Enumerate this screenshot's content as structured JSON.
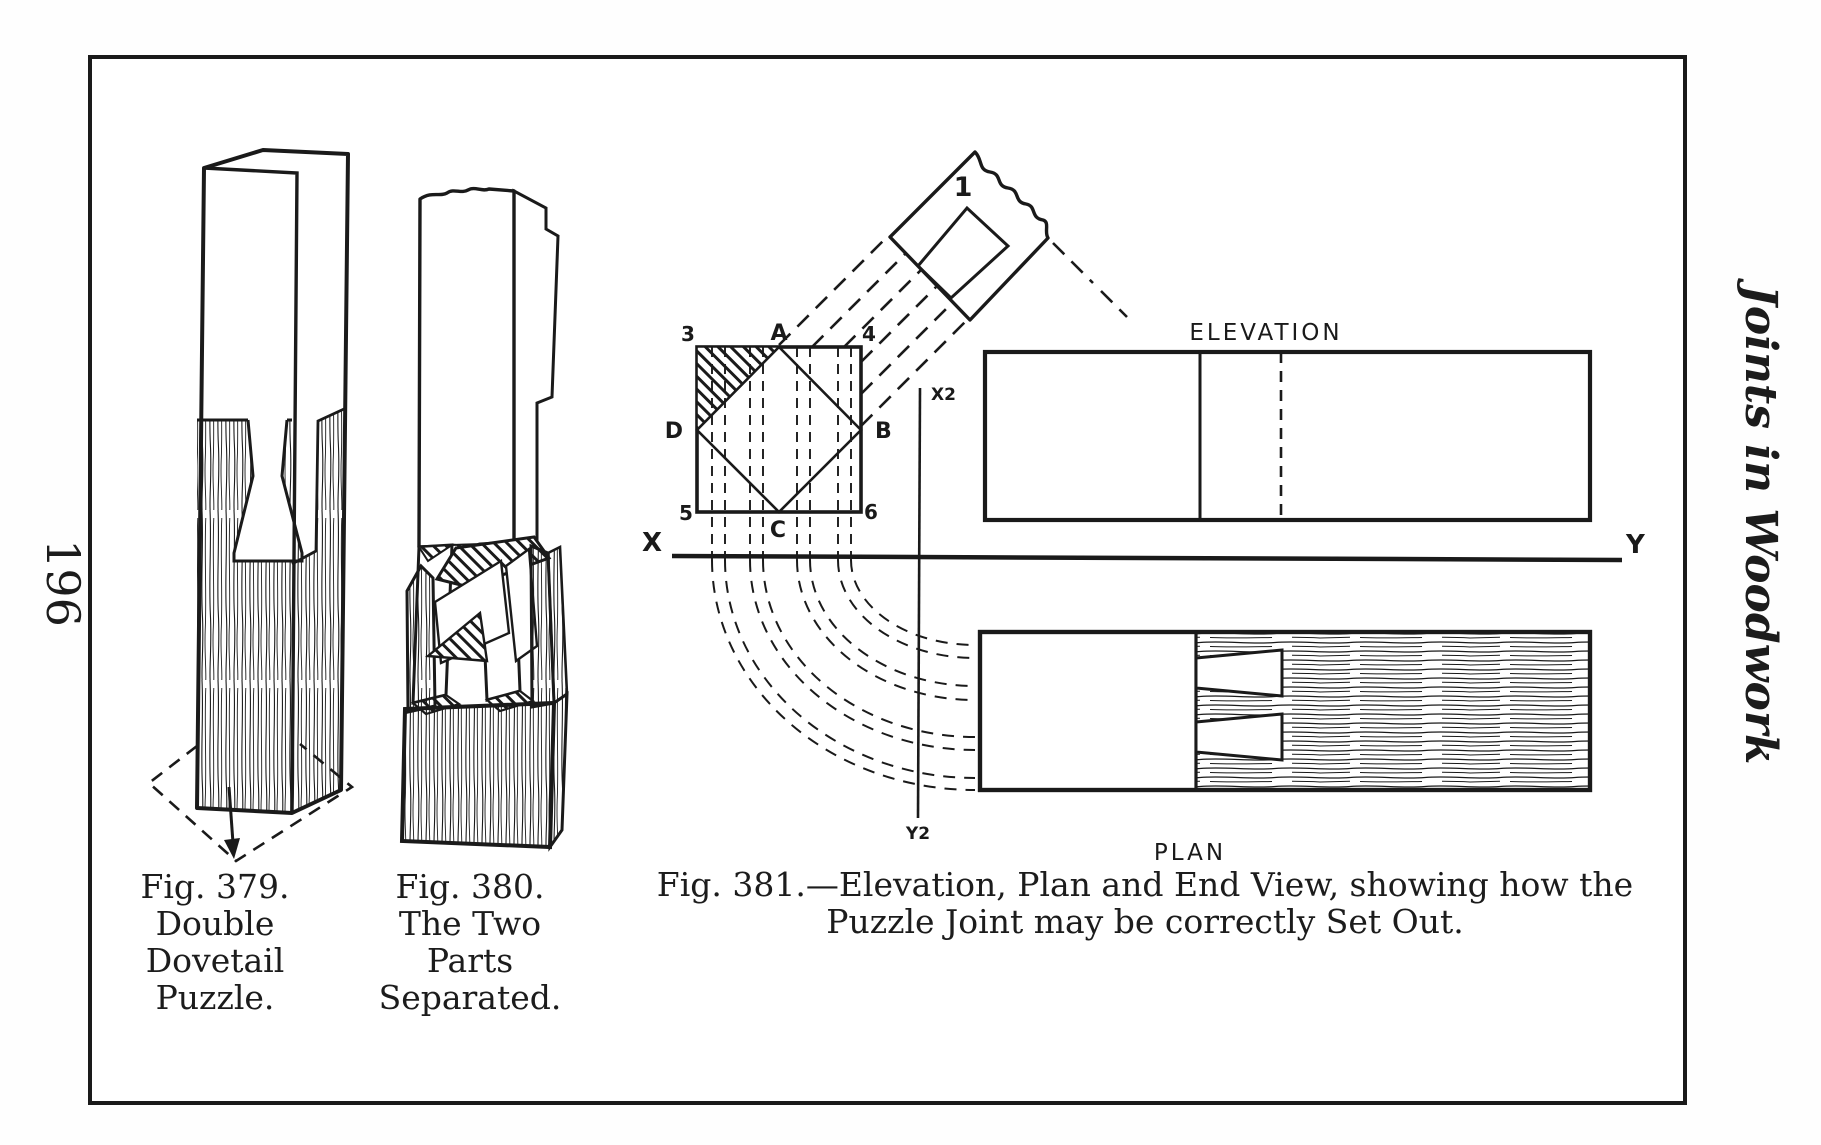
{
  "page": {
    "number": "196",
    "running_head": "Joints in Woodwork"
  },
  "fig379": {
    "caption": [
      "Fig. 379.",
      "Double",
      "Dovetail",
      "Puzzle."
    ]
  },
  "fig380": {
    "caption": [
      "Fig. 380.",
      "The Two",
      "Parts",
      "Separated."
    ]
  },
  "fig381": {
    "caption": [
      "Fig. 381.—Elevation, Plan and End View, showing how the",
      "Puzzle Joint may be correctly Set Out."
    ],
    "view_labels": {
      "elevation": "ELEVATION",
      "plan": "PLAN"
    },
    "axis_labels": {
      "x": "X",
      "y": "Y",
      "x2": "X2",
      "y2": "Y2"
    },
    "point_labels": {
      "a": "A",
      "b": "B",
      "c": "C",
      "d": "D"
    },
    "corner_labels": {
      "c3": "3",
      "c4": "4",
      "c5": "5",
      "c6": "6"
    },
    "piece_label": "1"
  },
  "colors": {
    "ink": "#1a1a1a",
    "paper": "#ffffff"
  }
}
